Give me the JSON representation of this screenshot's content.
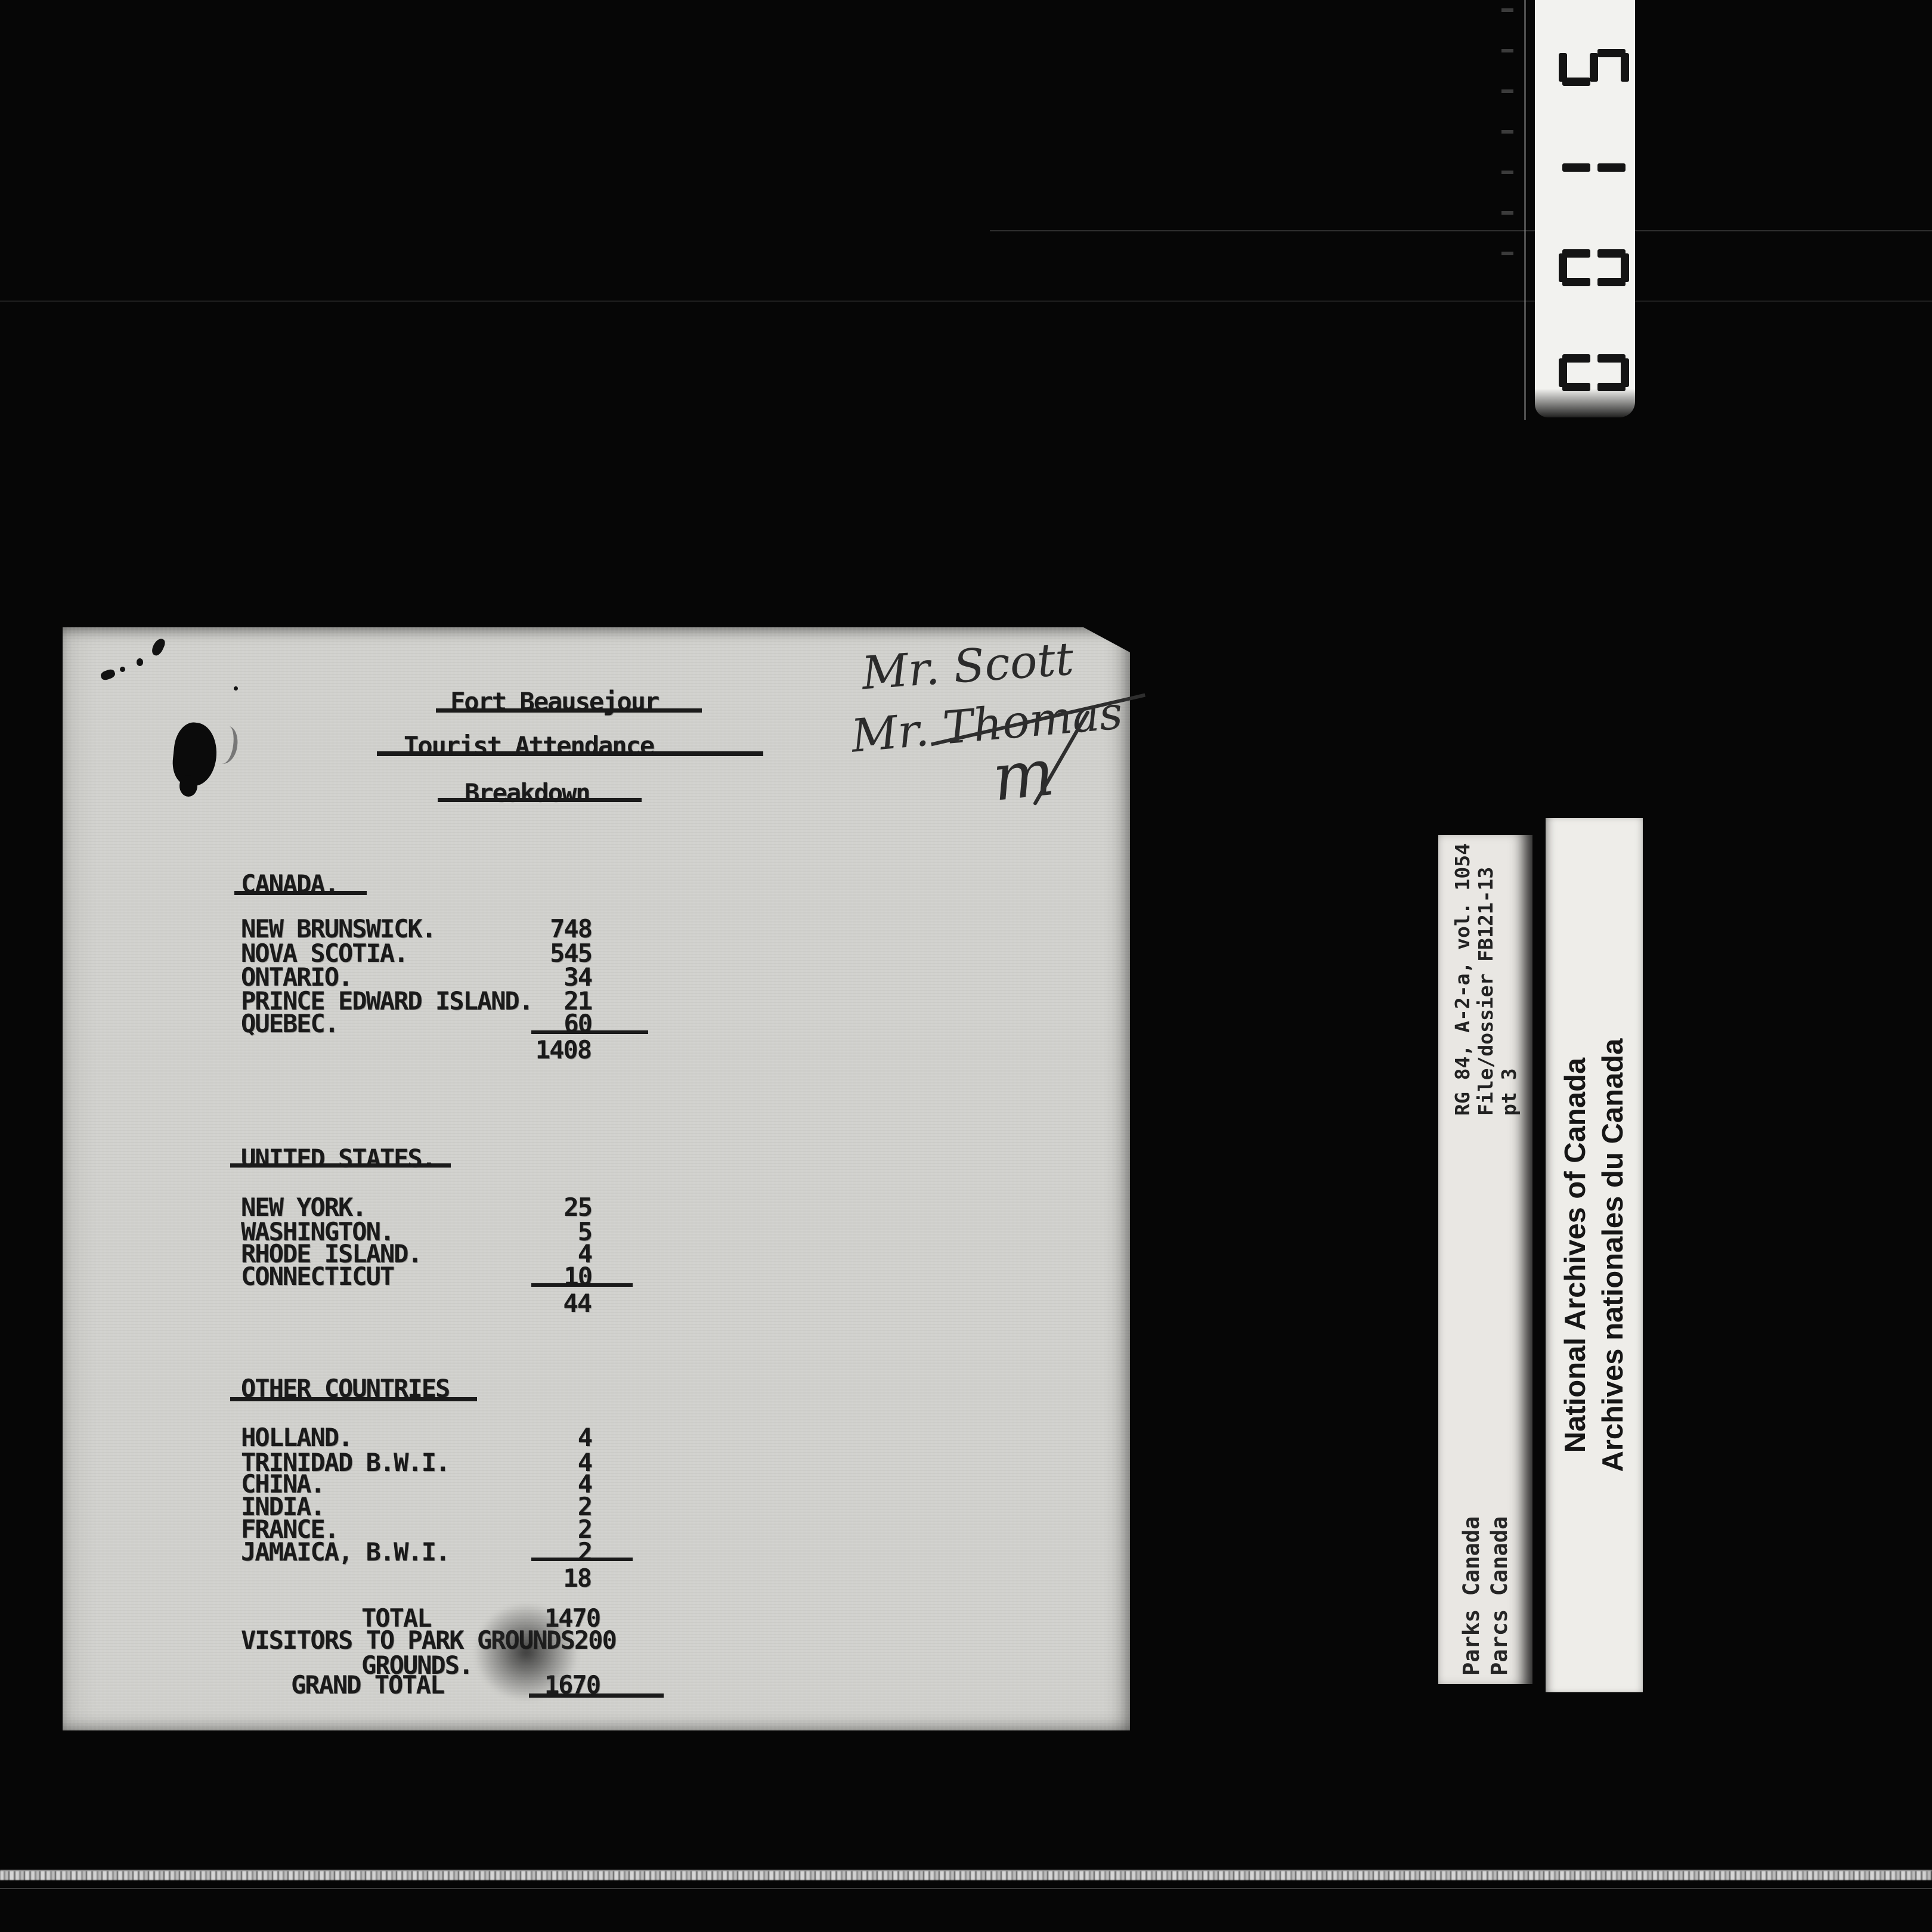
{
  "colors": {
    "background": "#060606",
    "paper": "#d2d2ce",
    "ink": "#1a1a1a",
    "label_strip": "#e9e7e3",
    "counter_strip": "#f2f2ef",
    "handwriting": "#2b2b2b"
  },
  "frame_counter": {
    "digits_top_to_bottom": [
      "5",
      "1",
      "0",
      "0"
    ],
    "reads_as": "0015"
  },
  "handwriting": {
    "line1": "Mr. Scott",
    "line2": "Mr. Thomas",
    "signature_initial": "m"
  },
  "document": {
    "title_lines": [
      "Fort Beausejour",
      "Tourist Attendance",
      "Breakdown"
    ],
    "sections": [
      {
        "heading": "CANADA.",
        "rows": [
          {
            "label": "NEW BRUNSWICK.",
            "value": "748"
          },
          {
            "label": "NOVA SCOTIA.",
            "value": "545"
          },
          {
            "label": "ONTARIO.",
            "value": "34"
          },
          {
            "label": "PRINCE EDWARD ISLAND.",
            "value": "21"
          },
          {
            "label": "QUEBEC.",
            "value": "60"
          }
        ],
        "subtotal": "1408"
      },
      {
        "heading": "UNITED STATES.",
        "rows": [
          {
            "label": "NEW YORK.",
            "value": "25"
          },
          {
            "label": "WASHINGTON.",
            "value": "5"
          },
          {
            "label": "RHODE ISLAND.",
            "value": "4"
          },
          {
            "label": "CONNECTICUT",
            "value": "10"
          }
        ],
        "subtotal": "44"
      },
      {
        "heading": "OTHER COUNTRIES",
        "rows": [
          {
            "label": "HOLLAND.",
            "value": "4"
          },
          {
            "label": "TRINIDAD B.W.I.",
            "value": "4"
          },
          {
            "label": "CHINA.",
            "value": "4"
          },
          {
            "label": "INDIA.",
            "value": "2"
          },
          {
            "label": "FRANCE.",
            "value": "2"
          },
          {
            "label": "JAMAICA, B.W.I.",
            "value": "2"
          }
        ],
        "subtotal": "18"
      }
    ],
    "totals": [
      {
        "label": "TOTAL",
        "value": "1470"
      },
      {
        "label": "VISITORS TO PARK GROUNDS",
        "value": "200"
      },
      {
        "label": "GROUNDS.",
        "value": ""
      },
      {
        "label": "GRAND TOTAL",
        "value": "1670"
      }
    ]
  },
  "labels": {
    "archival_reference_lines": [
      "RG 84, A-2-a, vol. 1054",
      "File/dossier FB121-13",
      "pt 3"
    ],
    "parks_canada_lines": [
      "Parks Canada",
      "Parcs Canada"
    ],
    "national_archives_lines": [
      "National Archives of Canada",
      "Archives nationales du Canada"
    ]
  }
}
